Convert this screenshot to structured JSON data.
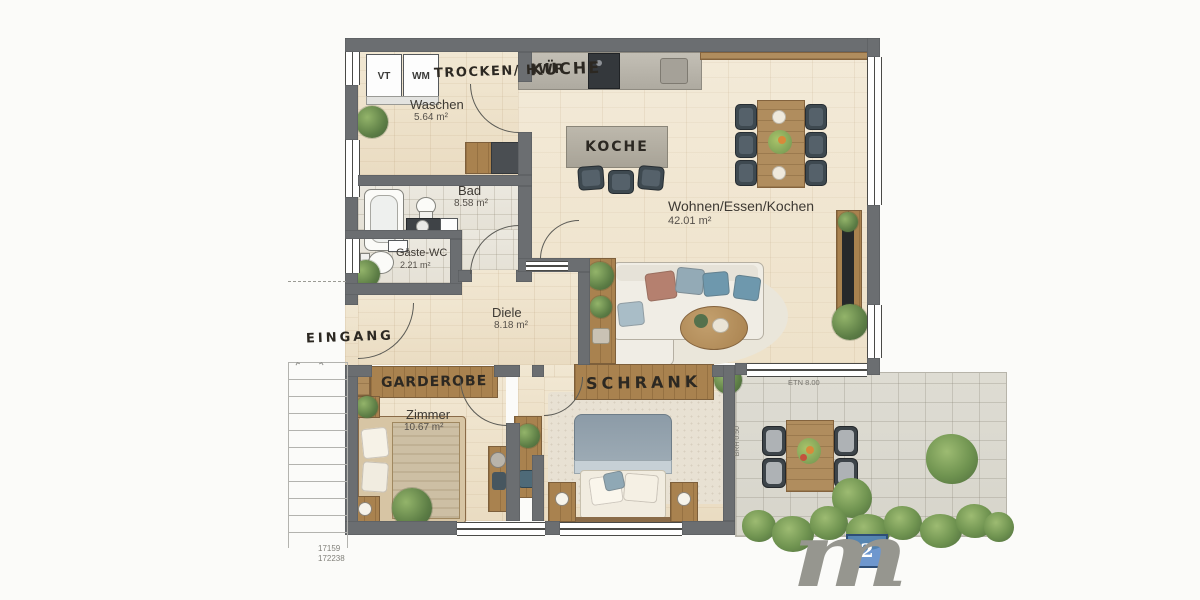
{
  "meta": {
    "type": "floor-plan",
    "style": "watercolor architectural rendering"
  },
  "rooms": {
    "trocken_hwr": {
      "label": "TROCKEN/ HWR"
    },
    "waschen": {
      "label": "Waschen",
      "area": "5.64 m²"
    },
    "kueche": {
      "label": "KÜCHE"
    },
    "koche_island": {
      "label": "KOCHE"
    },
    "wohnen": {
      "label": "Wohnen/Essen/Kochen",
      "area": "42.01 m²"
    },
    "bad": {
      "label": "Bad",
      "area": "8.58 m²"
    },
    "gaeste_wc": {
      "label": "Gäste-WC",
      "area": "2.21 m²"
    },
    "diele": {
      "label": "Diele",
      "area": "8.18 m²"
    },
    "zimmer": {
      "label": "Zimmer",
      "area": "10.67 m²"
    },
    "eingang": {
      "label": "EINGANG"
    },
    "garderobe": {
      "label": "GARDEROBE"
    },
    "schrank": {
      "label": "SCHRANK"
    }
  },
  "appliances": {
    "vt": "VT",
    "wm": "WM"
  },
  "annotations": {
    "terrace_note": "ETN 8.00",
    "sill_note": "BRH 0.50",
    "ref_line1": "17159",
    "ref_line2": "172238"
  },
  "icons": {
    "stair_arrow": "⌃"
  },
  "logo": {
    "letter": "m",
    "exponent": "2"
  },
  "colors": {
    "wall": "#6b6e71",
    "wood_floor": "#efe4cd",
    "tile_floor": "#e9e6de",
    "terrace_stone": "#dcdad2",
    "wardrobe_wood": "#a9824f",
    "accent_blue": "#4e80c4",
    "pillow_terracotta": "#b5806f",
    "pillow_blue": "#6e98ad",
    "chair_dark": "#3e4950",
    "plant_green": "#5c7d45"
  }
}
